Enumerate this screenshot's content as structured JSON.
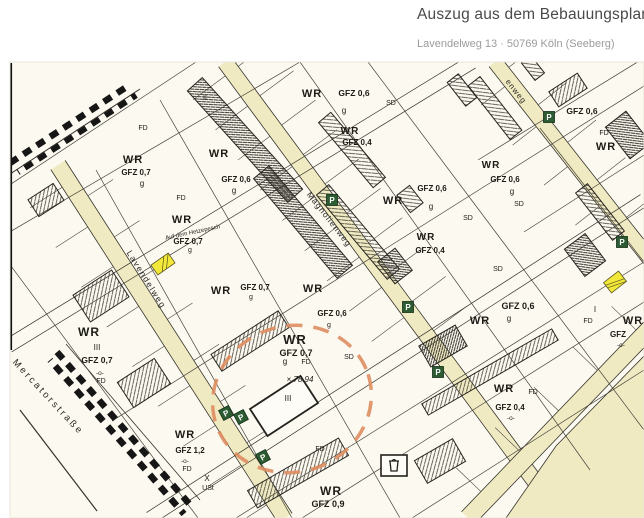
{
  "header": {
    "title": "Auszug aus dem Bebauungsplan",
    "subtitle": "Lavendelweg 13 · 50769 Köln (Seeberg)"
  },
  "map": {
    "colors": {
      "paper": "#fbf9f0",
      "street": "#f0eac2",
      "line": "#35332c",
      "parking_green": "#2d5c33",
      "highlight_yellow": "#f2e83a",
      "circle_orange": "#de8d60"
    },
    "parking_label": "P",
    "parking": [
      {
        "x": 549,
        "y": 117,
        "rot": 0
      },
      {
        "x": 332,
        "y": 200,
        "rot": 0
      },
      {
        "x": 622,
        "y": 242,
        "rot": 0
      },
      {
        "x": 408,
        "y": 307,
        "rot": 0
      },
      {
        "x": 438,
        "y": 372,
        "rot": 0
      },
      {
        "x": 226,
        "y": 413,
        "rot": -28
      },
      {
        "x": 241,
        "y": 417,
        "rot": -28
      },
      {
        "x": 263,
        "y": 457,
        "rot": -28
      }
    ],
    "street_names": [
      {
        "text": "Lavendelweg",
        "x": 144,
        "y": 281,
        "rot": 58,
        "size": 8.5,
        "spacing": 1.5
      },
      {
        "text": "Magnolienweg",
        "x": 327,
        "y": 221,
        "rot": 52,
        "size": 8.5,
        "spacing": 1
      },
      {
        "text": "Mercatorstraße",
        "x": 46,
        "y": 399,
        "rot": 47,
        "size": 9.5,
        "spacing": 2.5
      },
      {
        "text": "enweg",
        "x": 514,
        "y": 93,
        "rot": 52,
        "size": 8,
        "spacing": 1
      }
    ],
    "labels": [
      {
        "text": "WR",
        "x": 133,
        "y": 163,
        "size": 11,
        "bold": true
      },
      {
        "text": "GFZ 0,7",
        "x": 136,
        "y": 175,
        "size": 8,
        "bold": true
      },
      {
        "text": "g",
        "x": 142,
        "y": 186,
        "size": 8
      },
      {
        "text": "FD",
        "x": 143,
        "y": 130,
        "size": 7
      },
      {
        "text": "II",
        "x": 205,
        "y": 100,
        "size": 7
      },
      {
        "text": "WR",
        "x": 219,
        "y": 157,
        "size": 11,
        "bold": true
      },
      {
        "text": "GFZ 0,6",
        "x": 236,
        "y": 182,
        "size": 8,
        "bold": true
      },
      {
        "text": "g",
        "x": 234,
        "y": 193,
        "size": 8
      },
      {
        "text": "WR",
        "x": 312,
        "y": 97,
        "size": 11,
        "bold": true
      },
      {
        "text": "GFZ 0,6",
        "x": 354,
        "y": 96,
        "size": 8.5,
        "bold": true
      },
      {
        "text": "SD",
        "x": 391,
        "y": 105,
        "size": 7
      },
      {
        "text": "g",
        "x": 344,
        "y": 113,
        "size": 8
      },
      {
        "text": "WR",
        "x": 350,
        "y": 134,
        "size": 10,
        "bold": true
      },
      {
        "text": "GFZ 0,4",
        "x": 357,
        "y": 145,
        "size": 8,
        "bold": true
      },
      {
        "text": "GFZ 0,6",
        "x": 582,
        "y": 114,
        "size": 8.5,
        "bold": true
      },
      {
        "text": "FD",
        "x": 604,
        "y": 135,
        "size": 7
      },
      {
        "text": "WR",
        "x": 606,
        "y": 150,
        "size": 11,
        "bold": true
      },
      {
        "text": "WR",
        "x": 393,
        "y": 204,
        "size": 11,
        "bold": true
      },
      {
        "text": "g",
        "x": 431,
        "y": 209,
        "size": 8
      },
      {
        "text": "WR",
        "x": 426,
        "y": 240,
        "size": 10,
        "bold": true
      },
      {
        "text": "GFZ 0,4",
        "x": 430,
        "y": 253,
        "size": 8,
        "bold": true
      },
      {
        "text": "SD",
        "x": 468,
        "y": 220,
        "size": 7
      },
      {
        "text": "WR",
        "x": 491,
        "y": 168,
        "size": 10,
        "bold": true
      },
      {
        "text": "GFZ 0,6",
        "x": 505,
        "y": 182,
        "size": 8,
        "bold": true
      },
      {
        "text": "g",
        "x": 512,
        "y": 194,
        "size": 8
      },
      {
        "text": "SD",
        "x": 519,
        "y": 206,
        "size": 7
      },
      {
        "text": "GFZ 0,6",
        "x": 432,
        "y": 191,
        "size": 8,
        "bold": true
      },
      {
        "text": "SD",
        "x": 498,
        "y": 271,
        "size": 7
      },
      {
        "text": "WR",
        "x": 480,
        "y": 324,
        "size": 11,
        "bold": true
      },
      {
        "text": "GFZ 0,6",
        "x": 518,
        "y": 309,
        "size": 9,
        "bold": true
      },
      {
        "text": "g",
        "x": 509,
        "y": 321,
        "size": 8
      },
      {
        "text": "I",
        "x": 595,
        "y": 312,
        "size": 8
      },
      {
        "text": "FD",
        "x": 588,
        "y": 323,
        "size": 7
      },
      {
        "text": "WR",
        "x": 633,
        "y": 324,
        "size": 11,
        "bold": true
      },
      {
        "text": "GFZ",
        "x": 618,
        "y": 337,
        "size": 8,
        "bold": true
      },
      {
        "text": "-o-",
        "x": 621,
        "y": 347,
        "size": 6.5
      },
      {
        "text": "WR",
        "x": 182,
        "y": 223,
        "size": 11,
        "bold": true
      },
      {
        "text": "Auf dem Hetzepesch",
        "x": 193,
        "y": 234,
        "size": 6,
        "rot": -12
      },
      {
        "text": "GFZ 0,7",
        "x": 188,
        "y": 244,
        "size": 8,
        "bold": true
      },
      {
        "text": "g",
        "x": 190,
        "y": 252,
        "size": 7
      },
      {
        "text": "FD",
        "x": 181,
        "y": 200,
        "size": 7
      },
      {
        "text": "WR",
        "x": 221,
        "y": 294,
        "size": 11,
        "bold": true
      },
      {
        "text": "GFZ 0,7",
        "x": 255,
        "y": 290,
        "size": 8,
        "bold": true
      },
      {
        "text": "g",
        "x": 251,
        "y": 299,
        "size": 7
      },
      {
        "text": "WR",
        "x": 313,
        "y": 292,
        "size": 11,
        "bold": true
      },
      {
        "text": "GFZ 0,6",
        "x": 332,
        "y": 316,
        "size": 8,
        "bold": true
      },
      {
        "text": "g",
        "x": 329,
        "y": 327,
        "size": 7
      },
      {
        "text": "WR",
        "x": 89,
        "y": 336,
        "size": 12,
        "bold": true
      },
      {
        "text": "III",
        "x": 97,
        "y": 350,
        "size": 8
      },
      {
        "text": "GFZ 0,7",
        "x": 97,
        "y": 363,
        "size": 8.5,
        "bold": true
      },
      {
        "text": "-o-",
        "x": 100,
        "y": 375,
        "size": 6.5
      },
      {
        "text": "FD",
        "x": 101,
        "y": 383,
        "size": 7
      },
      {
        "text": "WR",
        "x": 295,
        "y": 344,
        "size": 13,
        "bold": true
      },
      {
        "text": "GFZ 0,7",
        "x": 296,
        "y": 356,
        "size": 9,
        "bold": true
      },
      {
        "text": "g",
        "x": 285,
        "y": 364,
        "size": 8
      },
      {
        "text": "FD",
        "x": 306,
        "y": 364,
        "size": 7
      },
      {
        "text": "× 78.94",
        "x": 300,
        "y": 382,
        "size": 8,
        "italic": true
      },
      {
        "text": "III",
        "x": 288,
        "y": 401,
        "size": 8
      },
      {
        "text": "SD",
        "x": 349,
        "y": 359,
        "size": 7
      },
      {
        "text": "WR",
        "x": 504,
        "y": 392,
        "size": 11,
        "bold": true
      },
      {
        "text": "FD",
        "x": 533,
        "y": 394,
        "size": 7
      },
      {
        "text": "GFZ 0,4",
        "x": 510,
        "y": 410,
        "size": 8,
        "bold": true
      },
      {
        "text": "-o-",
        "x": 511,
        "y": 420,
        "size": 6.5
      },
      {
        "text": "WR",
        "x": 185,
        "y": 438,
        "size": 11,
        "bold": true
      },
      {
        "text": "GFZ 1,2",
        "x": 190,
        "y": 453,
        "size": 8,
        "bold": true
      },
      {
        "text": "-o-",
        "x": 185,
        "y": 463,
        "size": 6.5
      },
      {
        "text": "FD",
        "x": 187,
        "y": 471,
        "size": 7
      },
      {
        "text": "X",
        "x": 207,
        "y": 481,
        "size": 8
      },
      {
        "text": "USt",
        "x": 208,
        "y": 490,
        "size": 7
      },
      {
        "text": "FD",
        "x": 320,
        "y": 451,
        "size": 7
      },
      {
        "text": "WR",
        "x": 331,
        "y": 495,
        "size": 12,
        "bold": true
      },
      {
        "text": "GFZ 0,9",
        "x": 328,
        "y": 507,
        "size": 9,
        "bold": true
      }
    ]
  }
}
